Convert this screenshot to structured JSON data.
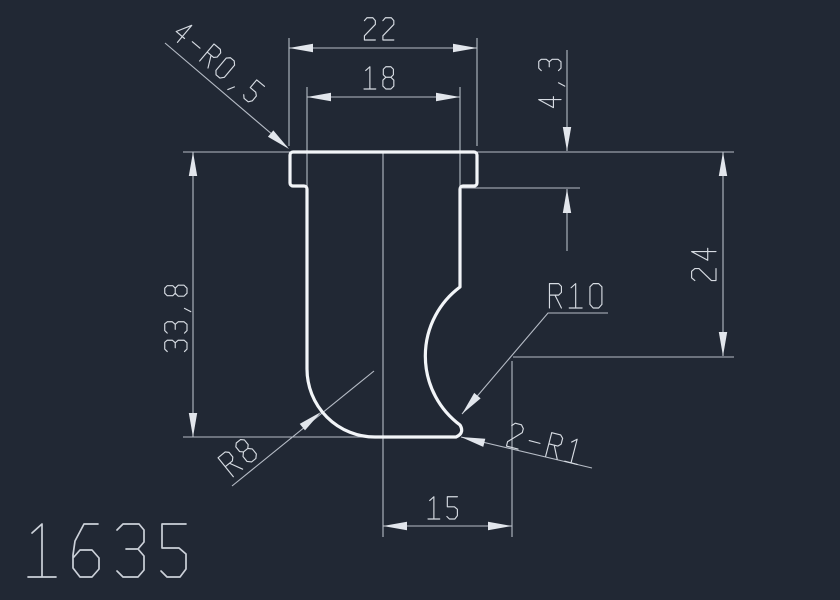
{
  "title": {
    "drawing_number": "1635"
  },
  "dimensions": {
    "flange_width": "22",
    "body_width": "18",
    "flange_thickness": "4,3",
    "radius_center_height": "24",
    "overall_height": "33,8",
    "radius_center_offset": "15"
  },
  "callouts": {
    "corner_fillets": "4-R0,5",
    "profile_radius": "R10",
    "bottom_left_radius": "R8",
    "bottom_fillets": "2-R1"
  },
  "colors": {
    "background": "#212834",
    "geometry_line": "#f2f5f8",
    "dimension_line": "#b6bcc6",
    "text": "#d6dbe2"
  }
}
